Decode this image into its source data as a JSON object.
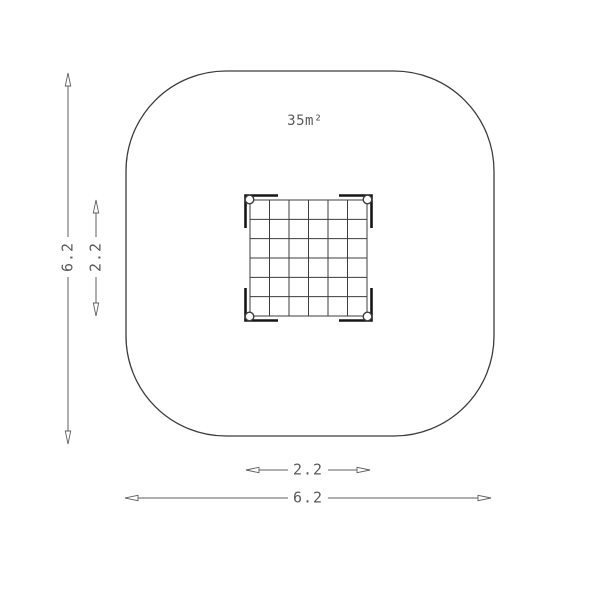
{
  "drawing": {
    "area_label": "35m²",
    "dim_outer_height": "6.2",
    "dim_inner_height": "2.2",
    "dim_inner_width": "2.2",
    "dim_outer_width": "6.2"
  },
  "grid": {
    "rows": 6,
    "cols": 6,
    "frame": {
      "x": 250,
      "y": 200,
      "w": 117,
      "h": 116
    }
  },
  "colors": {
    "background": "#ffffff",
    "line": "#3c3c3c",
    "bracket": "#161616",
    "dim": "#5f5f5f",
    "text": "#5a5a5a"
  }
}
